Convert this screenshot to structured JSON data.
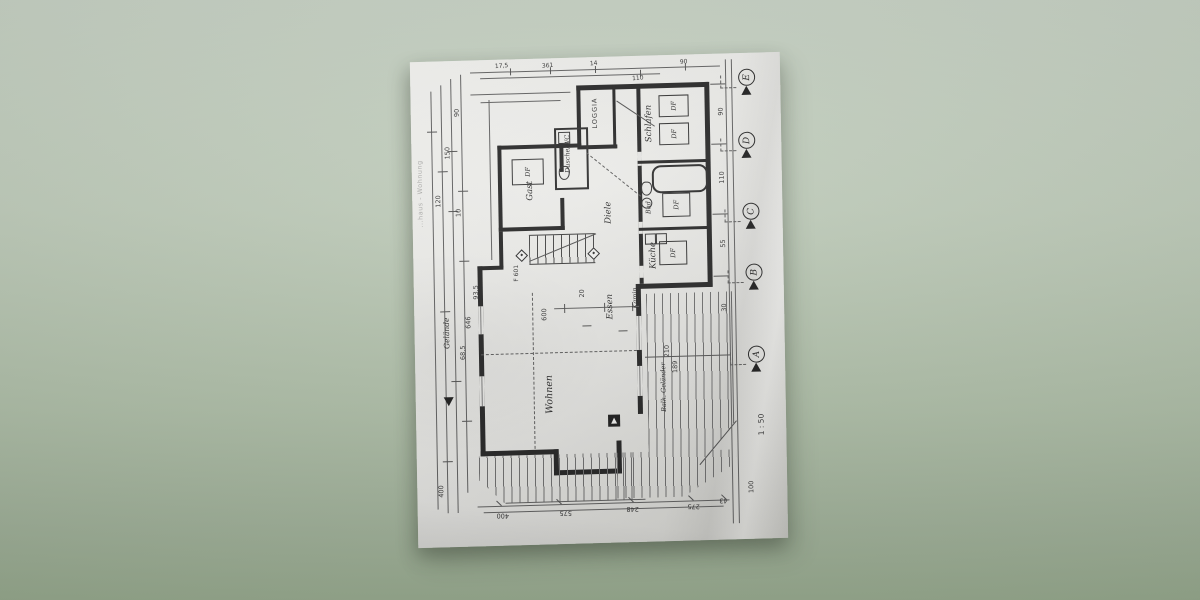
{
  "photo": {
    "surface_top_color": "#c4cfc1",
    "surface_bottom_color": "#99ac90",
    "paper_color": "#e9e9e6"
  },
  "plan": {
    "edge_note": "...haus - Wohnung",
    "scale_note": "1 : 50",
    "rooms": {
      "loggia": "LOGGIA",
      "gast": "Gast",
      "dusche_wc": "Dusche/WC",
      "diele": "Diele",
      "schlafen": "Schlafen",
      "bad": "Bad",
      "kueche": "Küche",
      "wohnen": "Wohnen",
      "essen": "Essen"
    },
    "annotations": {
      "df": "DF",
      "kamin": "Kamin",
      "gelaende": "Gelände",
      "balkon_gelaender": "Balk.-Geländer",
      "stair_ref": "F 601"
    },
    "grid_markers": {
      "e": "E",
      "d": "D",
      "c": "C",
      "b": "B",
      "a": "A"
    },
    "dimensions": {
      "top": [
        "17,5",
        "361",
        "14",
        "110",
        "90"
      ],
      "left": [
        "90",
        "150",
        "120",
        "10",
        "93,5",
        "646",
        "68,5",
        "400"
      ],
      "bottom": [
        "400",
        "575",
        "248",
        "275",
        "43"
      ],
      "right": [
        "90",
        "110",
        "55",
        "30",
        "100"
      ],
      "inner": [
        "600",
        "210",
        "189",
        "20"
      ]
    }
  }
}
